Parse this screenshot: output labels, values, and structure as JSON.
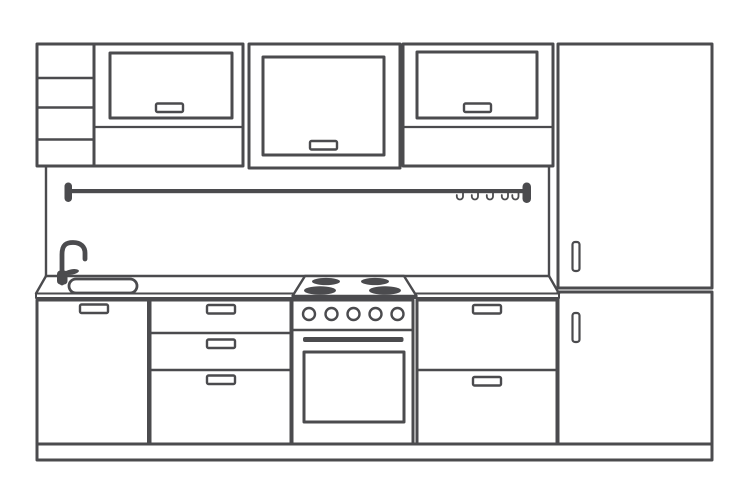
{
  "canvas": {
    "width": 750,
    "height": 500,
    "background": "#ffffff"
  },
  "palette": {
    "line": "#4b4b4e",
    "white": "#ffffff"
  },
  "scene": {
    "title": "kitchen-elevation-line-drawing"
  },
  "shapes": [
    {
      "type": "rect",
      "name": "open-shelf-unit",
      "x": 37,
      "y": 44,
      "w": 57,
      "h": 122,
      "stroke": "line",
      "sw": 3
    },
    {
      "type": "line",
      "name": "open-shelf-divider-1",
      "x1": 37,
      "y1": 78,
      "x2": 94,
      "y2": 78,
      "stroke": "line",
      "sw": 2.4
    },
    {
      "type": "line",
      "name": "open-shelf-divider-2",
      "x1": 37,
      "y1": 107.5,
      "x2": 94,
      "y2": 107.5,
      "stroke": "line",
      "sw": 2.4
    },
    {
      "type": "line",
      "name": "open-shelf-divider-3",
      "x1": 37,
      "y1": 139.5,
      "x2": 94,
      "y2": 139.5,
      "stroke": "line",
      "sw": 2.4
    },
    {
      "type": "rect",
      "name": "wall-cabinet-left-frame",
      "x": 94,
      "y": 44,
      "w": 149,
      "h": 122,
      "stroke": "line",
      "sw": 3
    },
    {
      "type": "rect",
      "name": "wall-cabinet-left-door",
      "x": 110,
      "y": 53,
      "w": 122,
      "h": 65,
      "stroke": "line",
      "sw": 3
    },
    {
      "type": "rect",
      "name": "wall-cabinet-left-handle",
      "x": 156,
      "y": 103.5,
      "w": 27,
      "h": 8.5,
      "rx": 1.5,
      "stroke": "line",
      "sw": 2.4,
      "fill": "white"
    },
    {
      "type": "line",
      "name": "wall-cabinet-left-shelf-line",
      "x1": 94,
      "y1": 127,
      "x2": 243,
      "y2": 127,
      "stroke": "line",
      "sw": 2.2
    },
    {
      "type": "rect",
      "name": "wall-cabinet-middle-frame",
      "x": 249,
      "y": 44,
      "w": 151,
      "h": 124,
      "stroke": "line",
      "sw": 3
    },
    {
      "type": "rect",
      "name": "wall-cabinet-middle-door",
      "x": 263,
      "y": 57,
      "w": 121,
      "h": 98,
      "stroke": "line",
      "sw": 3
    },
    {
      "type": "rect",
      "name": "wall-cabinet-middle-handle",
      "x": 310,
      "y": 141,
      "w": 27,
      "h": 8.5,
      "rx": 1.5,
      "stroke": "line",
      "sw": 2.4,
      "fill": "white"
    },
    {
      "type": "rect",
      "name": "wall-cabinet-right-frame",
      "x": 403,
      "y": 44,
      "w": 150,
      "h": 122,
      "stroke": "line",
      "sw": 3
    },
    {
      "type": "rect",
      "name": "wall-cabinet-right-door",
      "x": 417,
      "y": 52,
      "w": 120,
      "h": 66,
      "stroke": "line",
      "sw": 3
    },
    {
      "type": "rect",
      "name": "wall-cabinet-right-handle",
      "x": 464,
      "y": 103.5,
      "w": 27,
      "h": 8.5,
      "rx": 1.5,
      "stroke": "line",
      "sw": 2.4,
      "fill": "white"
    },
    {
      "type": "line",
      "name": "wall-cabinet-right-shelf-line",
      "x1": 403,
      "y1": 127,
      "x2": 553,
      "y2": 127,
      "stroke": "line",
      "sw": 2.2
    },
    {
      "type": "rect",
      "name": "tall-cabinet-upper-door",
      "x": 558,
      "y": 44,
      "w": 154,
      "h": 244,
      "stroke": "line",
      "sw": 3
    },
    {
      "type": "rect",
      "name": "tall-cabinet-lower-door",
      "x": 558,
      "y": 292,
      "w": 154,
      "h": 152,
      "stroke": "line",
      "sw": 3
    },
    {
      "type": "rect",
      "name": "tall-cabinet-upper-handle",
      "x": 572.5,
      "y": 242,
      "w": 7,
      "h": 29,
      "rx": 2.5,
      "stroke": "line",
      "sw": 2.2,
      "fill": "white"
    },
    {
      "type": "rect",
      "name": "tall-cabinet-lower-handle",
      "x": 572.5,
      "y": 313,
      "w": 7,
      "h": 29,
      "rx": 2.5,
      "stroke": "line",
      "sw": 2.2,
      "fill": "white"
    },
    {
      "type": "line",
      "name": "backsplash-left-edge",
      "x1": 46,
      "y1": 167,
      "x2": 46,
      "y2": 276,
      "stroke": "line",
      "sw": 2.4
    },
    {
      "type": "line",
      "name": "backsplash-right-edge",
      "x1": 549,
      "y1": 167,
      "x2": 549,
      "y2": 276,
      "stroke": "line",
      "sw": 2.4
    },
    {
      "type": "rect",
      "name": "utensil-rail-bar",
      "x": 69,
      "y": 189,
      "w": 455,
      "h": 4.2,
      "fill": "line"
    },
    {
      "type": "rect",
      "name": "utensil-rail-left-cap",
      "x": 64.5,
      "y": 182.5,
      "w": 7.5,
      "h": 19.5,
      "rx": 3.7,
      "fill": "line"
    },
    {
      "type": "rect",
      "name": "utensil-rail-right-cap",
      "x": 522.5,
      "y": 182.5,
      "w": 8.5,
      "h": 20.5,
      "rx": 4.2,
      "fill": "line"
    },
    {
      "type": "path",
      "name": "rail-hook-1",
      "d": "M 463,193 l 0,3.4 a 3.1,3.1 0 0 1 -6.2,0 l 0,-1.4",
      "stroke": "line",
      "sw": 1.8
    },
    {
      "type": "path",
      "name": "rail-hook-2",
      "d": "M 478,193 l 0,3.4 a 3.1,3.1 0 0 1 -6.2,0 l 0,-1.4",
      "stroke": "line",
      "sw": 1.8
    },
    {
      "type": "path",
      "name": "rail-hook-3",
      "d": "M 493,193 l 0,3.4 a 3.1,3.1 0 0 1 -6.2,0 l 0,-1.4",
      "stroke": "line",
      "sw": 1.8
    },
    {
      "type": "path",
      "name": "rail-hook-4",
      "d": "M 508,193 l 0,3.4 a 3.1,3.1 0 0 1 -6.2,0 l 0,-1.4",
      "stroke": "line",
      "sw": 1.8
    },
    {
      "type": "path",
      "name": "rail-hook-5",
      "d": "M 518.5,193 l 0,3.4 a 3.1,3.1 0 0 1 -6.2,0 l 0,-1.4",
      "stroke": "line",
      "sw": 1.8
    },
    {
      "type": "line",
      "name": "countertop-back-edge",
      "x1": 46,
      "y1": 276,
      "x2": 549,
      "y2": 276,
      "stroke": "line",
      "sw": 2.4
    },
    {
      "type": "line",
      "name": "countertop-left-end",
      "x1": 46,
      "y1": 276,
      "x2": 36,
      "y2": 293.5,
      "stroke": "line",
      "sw": 2.4
    },
    {
      "type": "line",
      "name": "countertop-right-end",
      "x1": 549,
      "y1": 276,
      "x2": 559,
      "y2": 293.5,
      "stroke": "line",
      "sw": 2.4
    },
    {
      "type": "rect",
      "name": "countertop-front-edge",
      "x": 36,
      "y": 293.5,
      "w": 523,
      "h": 4.5,
      "stroke": "line",
      "sw": 2,
      "fill": "white"
    },
    {
      "type": "rect",
      "name": "sink-basin",
      "x": 69,
      "y": 279,
      "w": 68,
      "h": 14,
      "rx": 7,
      "stroke": "line",
      "sw": 2.8,
      "fill": "white"
    },
    {
      "type": "polygon",
      "name": "cooktop-surface",
      "points": "305,276 404,276 416.5,296 292.5,296",
      "stroke": "line",
      "sw": 2.4,
      "fill": "white"
    },
    {
      "type": "ellipse",
      "name": "burner-back-left",
      "cx": 326,
      "cy": 281.5,
      "rx": 14,
      "ry": 3.6,
      "fill": "line"
    },
    {
      "type": "ellipse",
      "name": "burner-front-left",
      "cx": 320,
      "cy": 290.5,
      "rx": 16,
      "ry": 4.2,
      "fill": "line"
    },
    {
      "type": "ellipse",
      "name": "burner-back-right",
      "cx": 375,
      "cy": 281.5,
      "rx": 14,
      "ry": 3.6,
      "fill": "line"
    },
    {
      "type": "ellipse",
      "name": "burner-front-right",
      "cx": 385,
      "cy": 290.5,
      "rx": 16,
      "ry": 4.2,
      "fill": "line"
    },
    {
      "type": "path",
      "name": "faucet-spout",
      "d": "M 62,283 L 62,254.5 C 62,244.5 66.5,242.5 73,242.5 C 81,242.5 85,247 85,253 L 85,259",
      "stroke": "line",
      "sw": 4.8
    },
    {
      "type": "ellipse",
      "name": "faucet-lever",
      "cx": 71.5,
      "cy": 272,
      "rx": 7.5,
      "ry": 2.7,
      "rotate": -10,
      "fill": "line"
    },
    {
      "type": "rect",
      "name": "faucet-base",
      "x": 57,
      "y": 270.5,
      "w": 10.5,
      "h": 14,
      "rx": 3.5,
      "fill": "line"
    },
    {
      "type": "rect",
      "name": "base-cabinet-left-door",
      "x": 37,
      "y": 300,
      "w": 111.5,
      "h": 144,
      "stroke": "line",
      "sw": 3
    },
    {
      "type": "rect",
      "name": "base-cabinet-left-handle",
      "x": 80,
      "y": 304.5,
      "w": 28,
      "h": 8.5,
      "rx": 1.5,
      "stroke": "line",
      "sw": 2.4,
      "fill": "white"
    },
    {
      "type": "rect",
      "name": "drawer-unit-frame",
      "x": 150,
      "y": 300,
      "w": 141,
      "h": 144,
      "stroke": "line",
      "sw": 3
    },
    {
      "type": "line",
      "name": "drawer-divider-1",
      "x1": 150,
      "y1": 333,
      "x2": 291,
      "y2": 333,
      "stroke": "line",
      "sw": 2.4
    },
    {
      "type": "line",
      "name": "drawer-divider-2",
      "x1": 150,
      "y1": 370,
      "x2": 291,
      "y2": 370,
      "stroke": "line",
      "sw": 2.4
    },
    {
      "type": "rect",
      "name": "drawer-handle-1",
      "x": 207,
      "y": 305,
      "w": 28,
      "h": 8.5,
      "rx": 1.5,
      "stroke": "line",
      "sw": 2.4,
      "fill": "white"
    },
    {
      "type": "rect",
      "name": "drawer-handle-2",
      "x": 207,
      "y": 339.5,
      "w": 28,
      "h": 8.5,
      "rx": 1.5,
      "stroke": "line",
      "sw": 2.4,
      "fill": "white"
    },
    {
      "type": "rect",
      "name": "drawer-handle-3",
      "x": 207,
      "y": 375.5,
      "w": 28,
      "h": 8.5,
      "rx": 1.5,
      "stroke": "line",
      "sw": 2.4,
      "fill": "white"
    },
    {
      "type": "rect",
      "name": "oven-body",
      "x": 292,
      "y": 300,
      "w": 121,
      "h": 144,
      "stroke": "line",
      "sw": 3
    },
    {
      "type": "circle",
      "name": "oven-knob-1",
      "cx": 309,
      "cy": 314,
      "r": 6,
      "stroke": "line",
      "sw": 2.4,
      "fill": "white"
    },
    {
      "type": "circle",
      "name": "oven-knob-2",
      "cx": 331.5,
      "cy": 314,
      "r": 6,
      "stroke": "line",
      "sw": 2.4,
      "fill": "white"
    },
    {
      "type": "circle",
      "name": "oven-knob-3",
      "cx": 353.5,
      "cy": 314,
      "r": 6,
      "stroke": "line",
      "sw": 2.4,
      "fill": "white"
    },
    {
      "type": "circle",
      "name": "oven-knob-4",
      "cx": 375.5,
      "cy": 314,
      "r": 6,
      "stroke": "line",
      "sw": 2.4,
      "fill": "white"
    },
    {
      "type": "circle",
      "name": "oven-knob-5",
      "cx": 397.5,
      "cy": 314,
      "r": 6,
      "stroke": "line",
      "sw": 2.4,
      "fill": "white"
    },
    {
      "type": "line",
      "name": "oven-door-top",
      "x1": 292,
      "y1": 330,
      "x2": 413,
      "y2": 330,
      "stroke": "line",
      "sw": 2.4
    },
    {
      "type": "rect",
      "name": "oven-handle-bar",
      "x": 303,
      "y": 337,
      "w": 100.5,
      "h": 5,
      "rx": 2,
      "fill": "line"
    },
    {
      "type": "rect",
      "name": "oven-window",
      "x": 304,
      "y": 352,
      "w": 100,
      "h": 70,
      "stroke": "line",
      "sw": 3,
      "fill": "white"
    },
    {
      "type": "rect",
      "name": "base-cabinet-right-frame",
      "x": 417,
      "y": 300,
      "w": 140,
      "h": 144,
      "stroke": "line",
      "sw": 3
    },
    {
      "type": "line",
      "name": "base-cabinet-right-divider",
      "x1": 417,
      "y1": 370,
      "x2": 557,
      "y2": 370,
      "stroke": "line",
      "sw": 2.4
    },
    {
      "type": "rect",
      "name": "base-cabinet-right-handle-top",
      "x": 473,
      "y": 305,
      "w": 28,
      "h": 8.5,
      "rx": 1.5,
      "stroke": "line",
      "sw": 2.4,
      "fill": "white"
    },
    {
      "type": "rect",
      "name": "base-cabinet-right-handle-bottom",
      "x": 473,
      "y": 377,
      "w": 28,
      "h": 8.5,
      "rx": 1.5,
      "stroke": "line",
      "sw": 2.4,
      "fill": "white"
    },
    {
      "type": "rect",
      "name": "plinth",
      "x": 37,
      "y": 444,
      "w": 675,
      "h": 16,
      "stroke": "line",
      "sw": 3,
      "fill": "white"
    }
  ]
}
